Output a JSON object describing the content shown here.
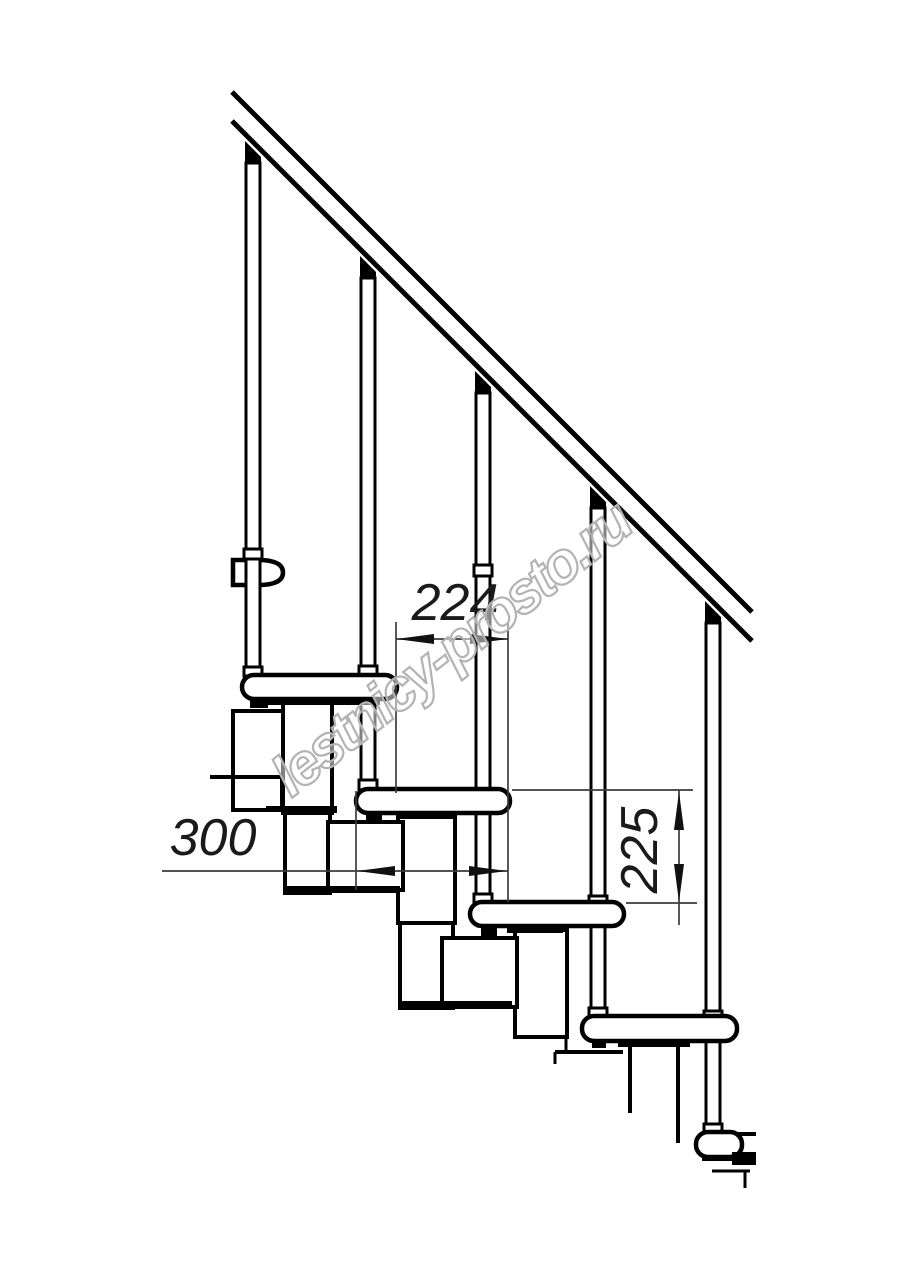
{
  "drawing": {
    "description": "Modular staircase side-view technical drawing",
    "background": "#ffffff",
    "line_color": "#000000",
    "dimension_color": "#3c3c3c"
  },
  "dimension_labels": {
    "step_offset": "224",
    "tread_length": "300",
    "step_rise": "225"
  },
  "watermark": {
    "text": "lestnicy-prosto.ru",
    "color": "#b3b3b3"
  },
  "counts": {
    "balusters": 5,
    "treads": 4
  }
}
